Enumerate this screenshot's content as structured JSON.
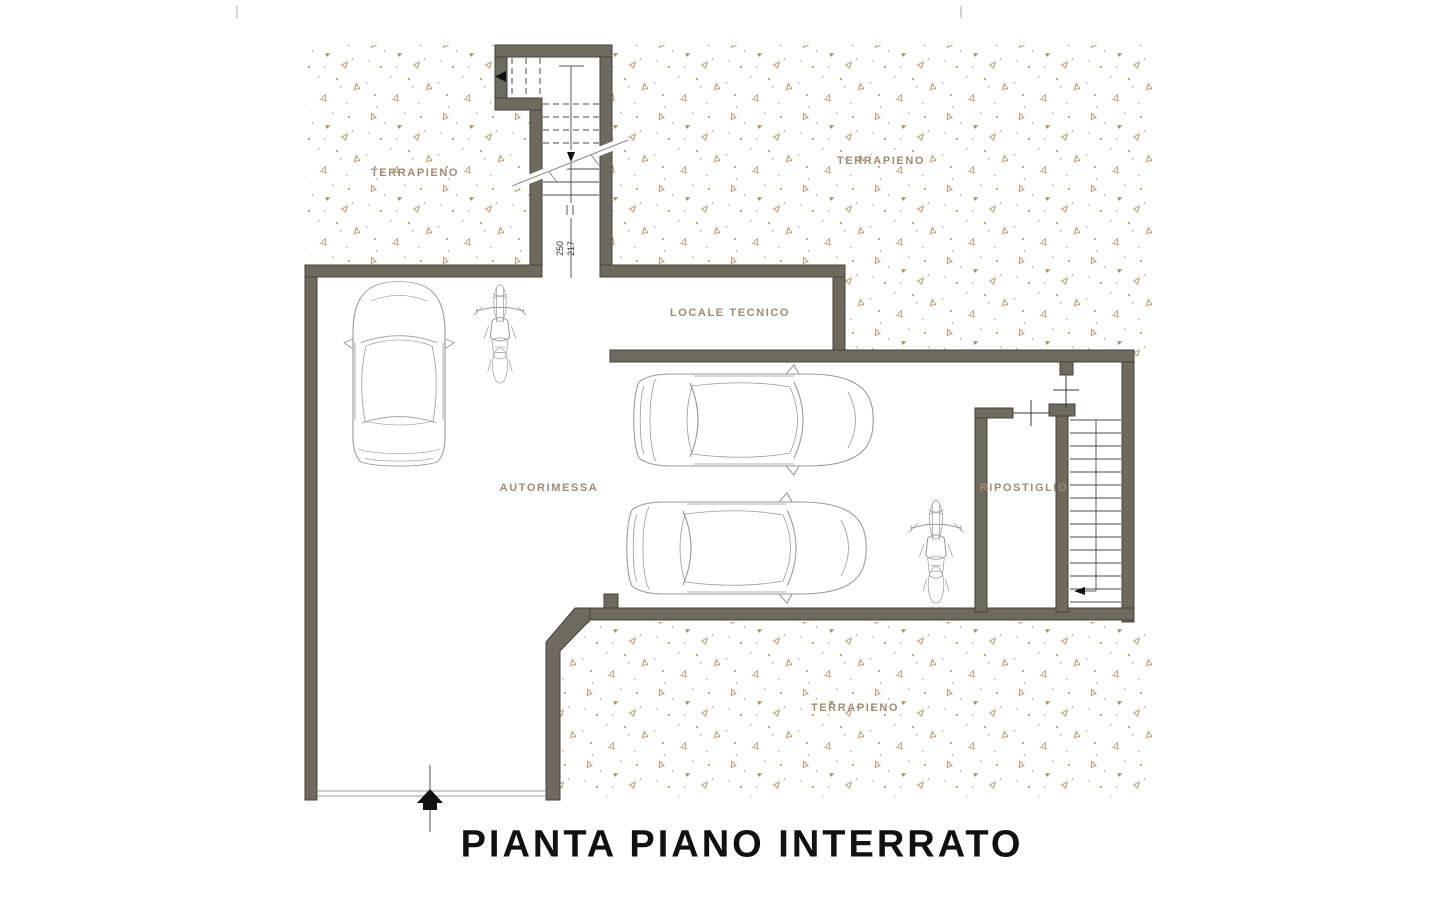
{
  "title": "PIANTA PIANO INTERRATO",
  "labels": {
    "terrapieno_top_left": "TERRAPIENO",
    "terrapieno_top_right": "TERRAPIENO",
    "terrapieno_bottom": "TERRAPIENO",
    "locale_tecnico": "LOCALE TECNICO",
    "autorimessa": "AUTORIMESSA",
    "ripostiglio": "RIPOSTIGLIO"
  },
  "stair_dimension": {
    "line1": "250",
    "line2": "217"
  },
  "colors": {
    "wall": "#6e6a5e",
    "wall_outline": "#45423a",
    "line_gray": "#9a9a9a",
    "label": "#a08a70",
    "stipple_tan": "#c08f55",
    "stipple_gray": "#bdbdbd",
    "title": "#111111"
  }
}
